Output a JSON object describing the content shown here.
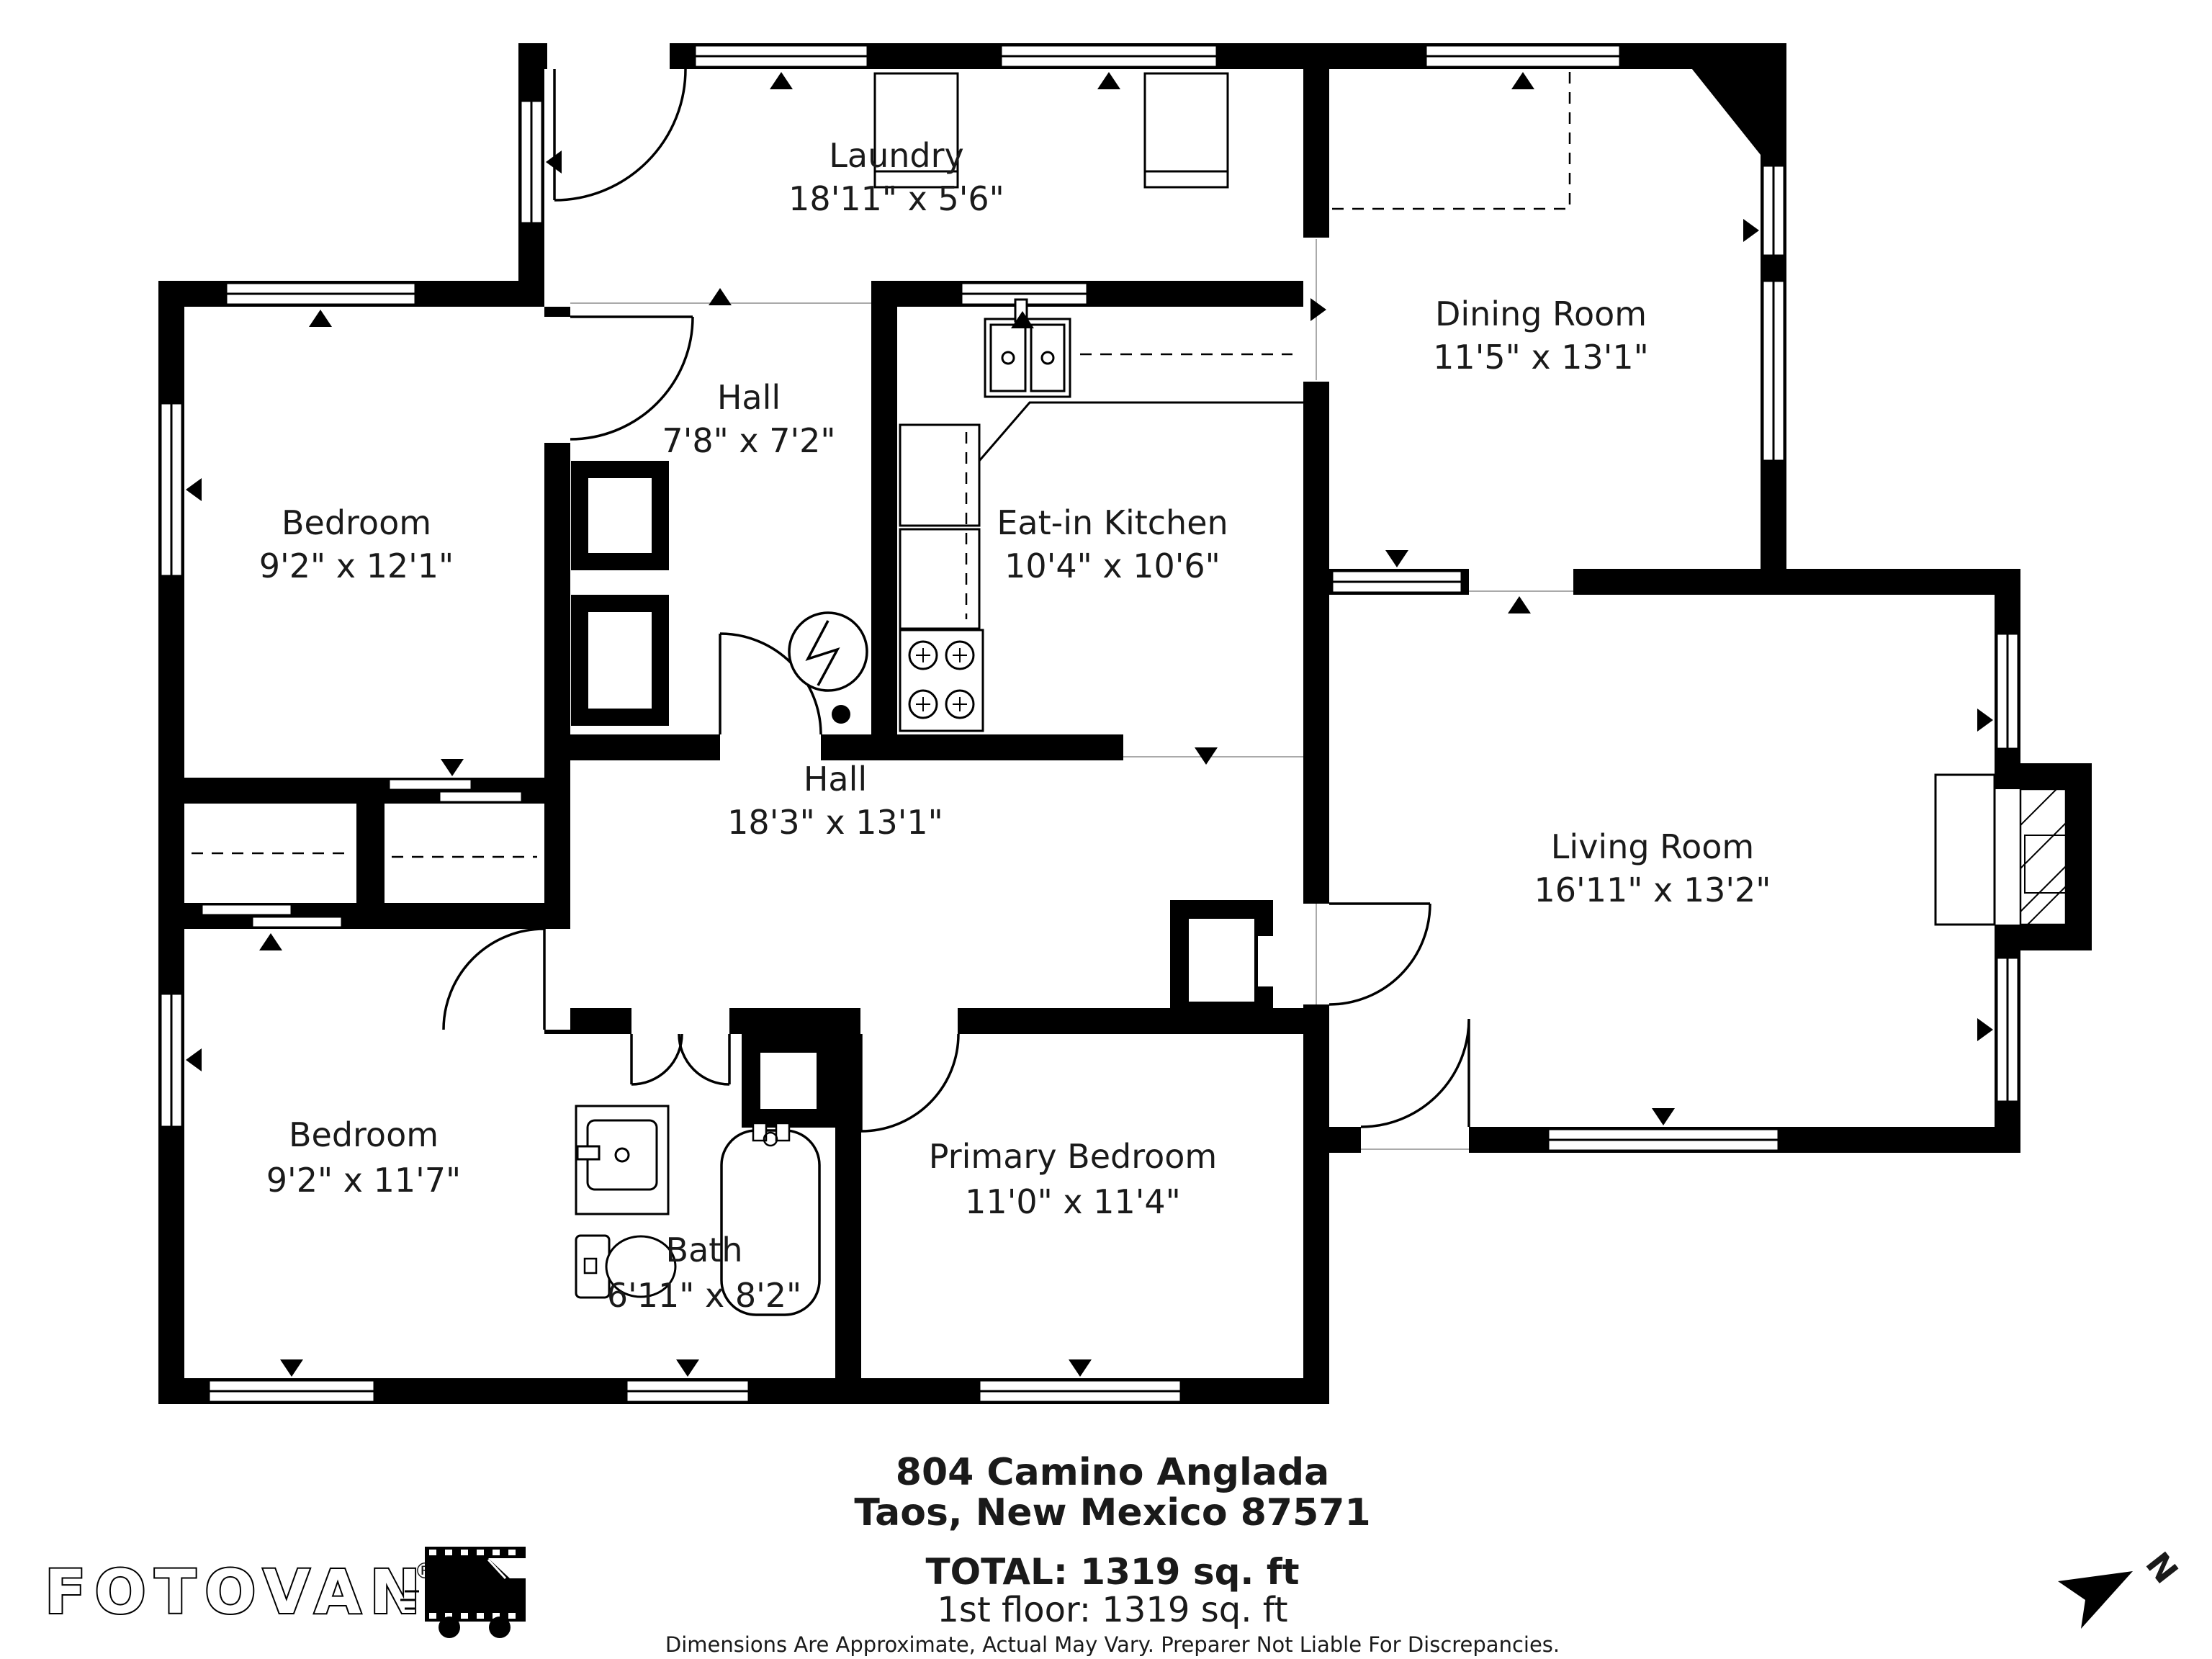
{
  "rooms": {
    "laundry": {
      "name": "Laundry",
      "dims": "18'11\" x 5'6\""
    },
    "dining_room": {
      "name": "Dining Room",
      "dims": "11'5\" x 13'1\""
    },
    "hall_upper": {
      "name": "Hall",
      "dims": "7'8\" x 7'2\""
    },
    "bedroom_upper_left": {
      "name": "Bedroom",
      "dims": "9'2\" x 12'1\""
    },
    "eat_in_kitchen": {
      "name": "Eat-in Kitchen",
      "dims": "10'4\" x 10'6\""
    },
    "hall_main": {
      "name": "Hall",
      "dims": "18'3\" x 13'1\""
    },
    "living_room": {
      "name": "Living Room",
      "dims": "16'11\" x 13'2\""
    },
    "bedroom_lower_left": {
      "name": "Bedroom",
      "dims": "9'2\" x 11'7\""
    },
    "bath": {
      "name": "Bath",
      "dims": "6'11\" x 8'2\""
    },
    "primary_bedroom": {
      "name": "Primary Bedroom",
      "dims": "11'0\" x 11'4\""
    }
  },
  "footer": {
    "address_line1": "804 Camino Anglada",
    "address_line2": "Taos, New Mexico 87571",
    "total": "TOTAL: 1319 sq. ft",
    "first_floor": "1st floor: 1319 sq. ft",
    "disclaimer": "Dimensions Are Approximate, Actual May Vary. Preparer Not Liable For Discrepancies."
  },
  "branding": {
    "logo_text": "FOTOVAN",
    "trademark": "®"
  },
  "compass": {
    "north_label": "N"
  },
  "colors": {
    "wall": "#000000",
    "floor": "#ffffff",
    "text": "#1a1a1a"
  }
}
